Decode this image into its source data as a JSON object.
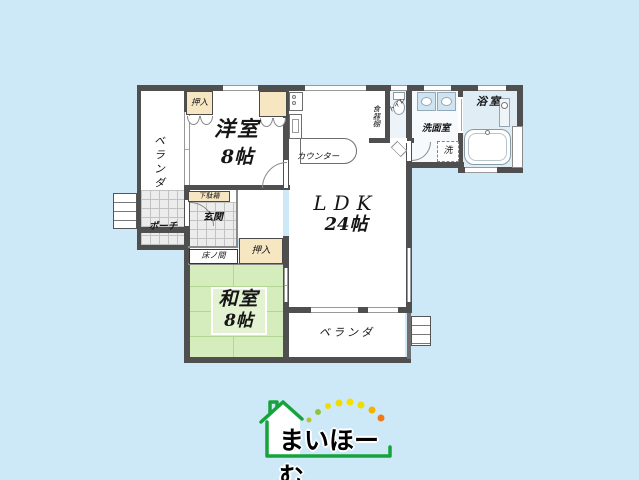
{
  "background_color": "#cde9f7",
  "floor_plan": {
    "veranda_top": "ベランダ",
    "closet_top": "押入",
    "western_room_name": "洋室",
    "western_room_size": "8帖",
    "ldk_name": "LDK",
    "ldk_size": "24帖",
    "counter": "カウンター",
    "cupboard": "食器棚",
    "toilet": "トイレ",
    "washroom": "洗面室",
    "laundry": "洗",
    "bathroom": "浴室",
    "shoe_cabinet": "下駄箱",
    "entrance": "玄関",
    "porch": "ポーチ",
    "tokonoma": "床ノ間",
    "closet_bottom": "押入",
    "japanese_room_name": "和室",
    "japanese_room_size": "8帖",
    "veranda_bottom": "ベランダ",
    "colors": {
      "wall": "#4f4f4f",
      "tatami_green": "#d5ecbc",
      "closet_cream": "#f7e6c2",
      "bath_floor": "#e0edf5",
      "tile_gray": "#ececec"
    },
    "icons": [
      "toilet-icon",
      "bathtub-icon",
      "washbasin-icon",
      "stove-icon",
      "kitchen-sink-icon",
      "stairs-icon",
      "shower-panel-icon",
      "door-swing-icon"
    ]
  },
  "logo": {
    "text": "まいほーむ",
    "house_color": "#17a33b",
    "dot_colors": [
      "#b9c42c",
      "#8cc63f",
      "#eedd00",
      "#f0dc00",
      "#f5e000",
      "#eedd00",
      "#f0b400",
      "#ef7a1a"
    ]
  }
}
